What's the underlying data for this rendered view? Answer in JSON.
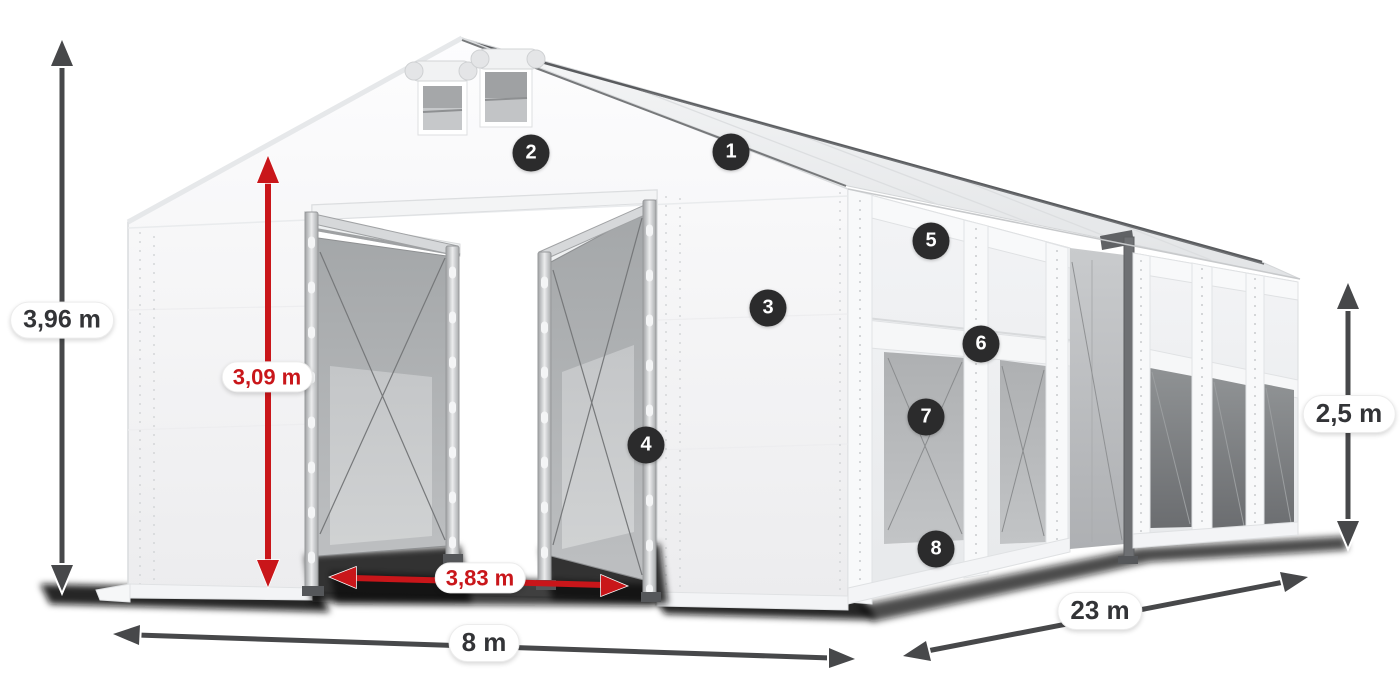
{
  "image": {
    "description": "White storage marquee tent shown in perspective with dimension arrows and numbered part markers",
    "background": "#ffffff"
  },
  "dimensions": {
    "total_height": {
      "value": "3,96 m",
      "style": "dark",
      "orientation": "vertical"
    },
    "entrance_height": {
      "value": "3,09 m",
      "style": "red",
      "orientation": "vertical"
    },
    "entrance_width": {
      "value": "3,83 m",
      "style": "red",
      "orientation": "horizontal"
    },
    "gable_width": {
      "value": "8 m",
      "style": "dark",
      "orientation": "horizontal"
    },
    "length": {
      "value": "23 m",
      "style": "dark",
      "orientation": "diagonal"
    },
    "sidewall_height": {
      "value": "2,5 m",
      "style": "dark",
      "orientation": "vertical"
    }
  },
  "part_markers": [
    {
      "number": "1"
    },
    {
      "number": "2"
    },
    {
      "number": "3"
    },
    {
      "number": "4"
    },
    {
      "number": "5"
    },
    {
      "number": "6"
    },
    {
      "number": "7"
    },
    {
      "number": "8"
    }
  ],
  "colors": {
    "dimension_red": "#c9161a",
    "dimension_dark": "#47484a",
    "label_text_dark": "#333437",
    "label_pill_bg": "#ffffff",
    "marker_bg": "#2b2b2c",
    "marker_text": "#ffffff",
    "tent_fabric": "#f5f6f7",
    "interior_panel_grey": "#b3b5b7",
    "ground_shadow": "#161616"
  }
}
